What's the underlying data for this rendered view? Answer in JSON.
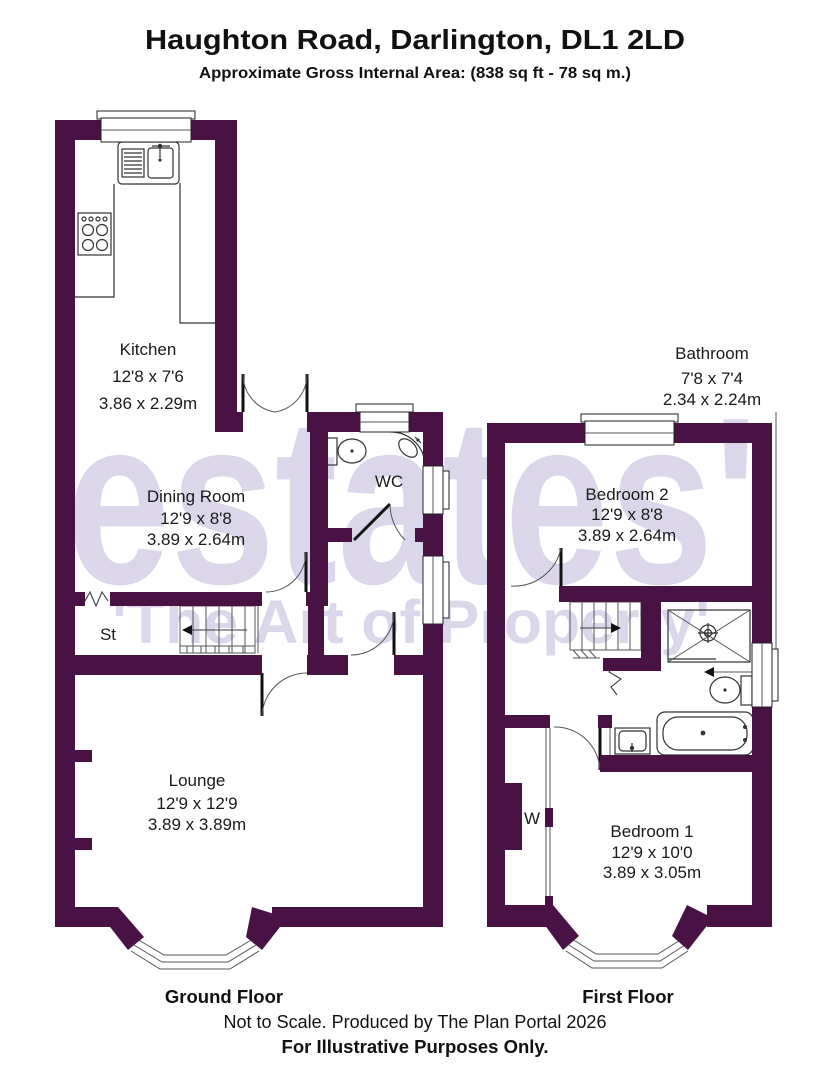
{
  "title": "Haughton Road, Darlington, DL1 2LD",
  "subtitle": "Approximate Gross Internal Area: (838 sq ft - 78 sq m.)",
  "watermark": {
    "line1": "estates'",
    "line2": "'The Art of Property'",
    "color": "#dcd6eb"
  },
  "colors": {
    "wall": "#491245",
    "line": "#333333",
    "label": "#1a1a1a"
  },
  "ground_floor": {
    "label": "Ground Floor",
    "rooms": {
      "kitchen": {
        "name": "Kitchen",
        "imperial": "12'8 x 7'6",
        "metric": "3.86 x 2.29m"
      },
      "dining": {
        "name": "Dining Room",
        "imperial": "12'9 x 8'8",
        "metric": "3.89 x 2.64m"
      },
      "wc": {
        "name": "WC"
      },
      "store": {
        "name": "St"
      },
      "lounge": {
        "name": "Lounge",
        "imperial": "12'9 x 12'9",
        "metric": "3.89 x 3.89m"
      }
    }
  },
  "first_floor": {
    "label": "First Floor",
    "rooms": {
      "bathroom": {
        "name": "Bathroom",
        "imperial": "7'8 x 7'4",
        "metric": "2.34 x 2.24m"
      },
      "bedroom2": {
        "name": "Bedroom 2",
        "imperial": "12'9 x 8'8",
        "metric": "3.89 x 2.64m"
      },
      "wardrobe": {
        "name": "W"
      },
      "bedroom1": {
        "name": "Bedroom 1",
        "imperial": "12'9 x 10'0",
        "metric": "3.89 x 3.05m"
      }
    }
  },
  "footer": {
    "note": "Not to Scale. Produced by The Plan Portal 2026",
    "disclaimer": "For Illustrative Purposes Only."
  }
}
